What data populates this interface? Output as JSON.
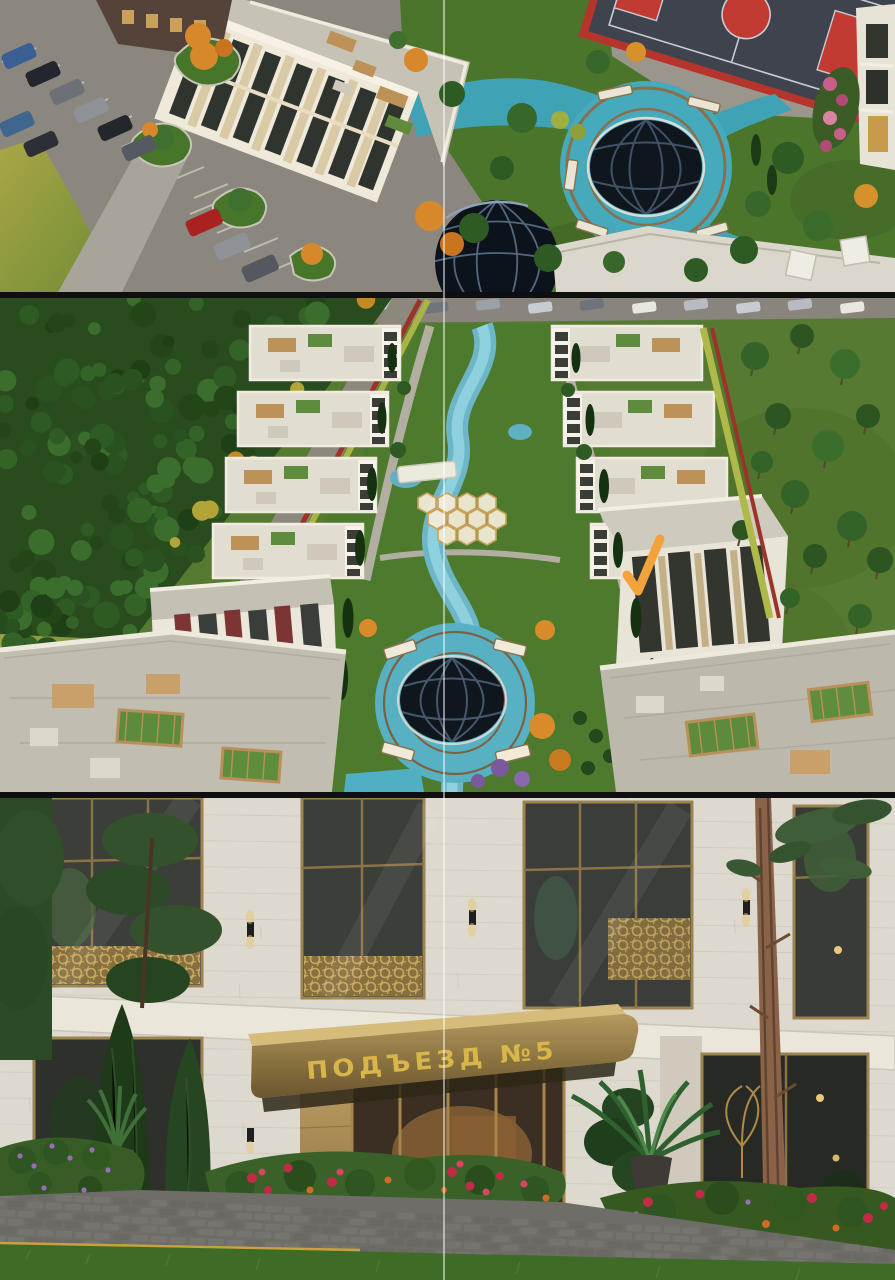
{
  "collage": {
    "separator_color": "#0f0f0f",
    "guide_line_color": "rgba(255,255,255,0.5)",
    "panels": [
      {
        "id": "aerial-fountain-plaza",
        "label": "aerial render: building, parking, fountain plaza, sports court"
      },
      {
        "id": "aerial-residential-rows",
        "label": "aerial render: residential rows with winding canal courtyard"
      },
      {
        "id": "entrance-facade",
        "label": "street render: building entrance with gold canopy"
      }
    ]
  },
  "entrance_sign": {
    "text": "ПОДЪЕЗД №5",
    "text_color": "#d9b54a",
    "canopy_color": "#8a7340"
  },
  "annotation_checkmark": {
    "type": "checkmark",
    "color": "#F2A33B"
  },
  "palette": {
    "teal_plaza": "#3fa3b5",
    "canal_blue": "#7ec2d2",
    "court_red": "#b5352c",
    "forest_green": "#2a5220",
    "facade_stone": "#e9e5d9",
    "gold_frame": "#9a8450",
    "lawn_green": "#4c7a2c",
    "dome_dark": "#10161e"
  }
}
